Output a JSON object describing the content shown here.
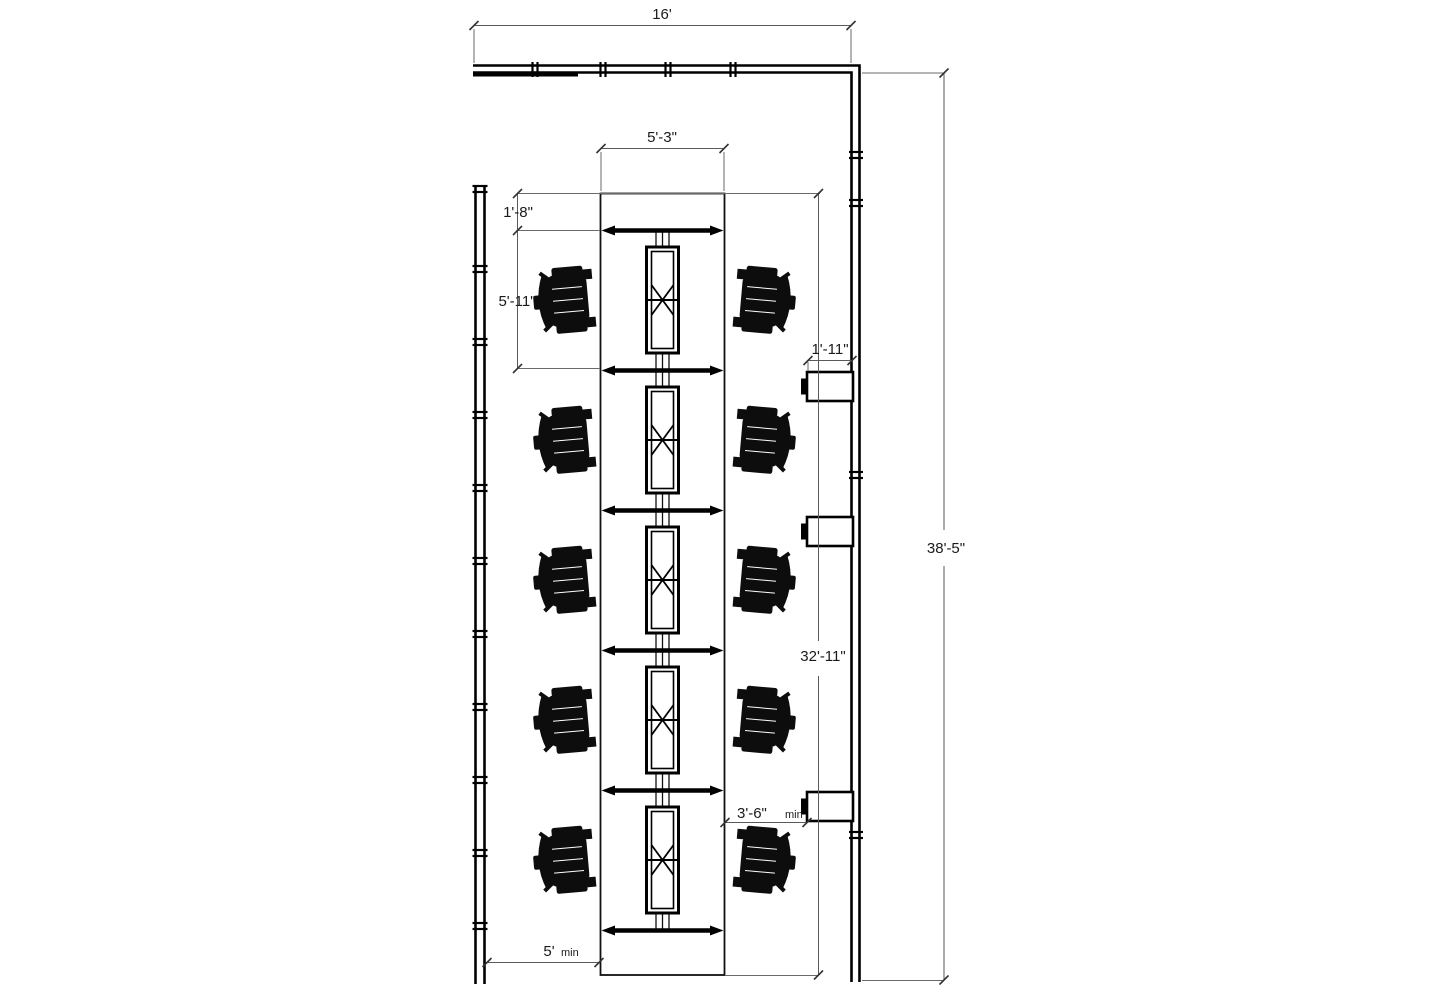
{
  "page": {
    "background": "#ffffff"
  },
  "drawing": {
    "type": "office-workstation-floor-plan",
    "line_color": "#000000",
    "dimension_line_color": "#5a5a5a",
    "text_color": "#1a1a1a",
    "workstation_modules": 5,
    "task_chairs": 10,
    "wall_cabinets": 3,
    "dimensions": {
      "top_wall_width": "16'",
      "worksurface_width": "5'-3\"",
      "end_overhang": "1'-8\"",
      "module_pitch": "5'-11\"",
      "cabinet_depth": "1'-11\"",
      "run_length": "32'-11\"",
      "room_depth": "38'-5\"",
      "right_clearance": "3'-6\"",
      "right_clearance_qualifier": "min",
      "left_clearance": "5'",
      "left_clearance_qualifier": "min"
    }
  }
}
